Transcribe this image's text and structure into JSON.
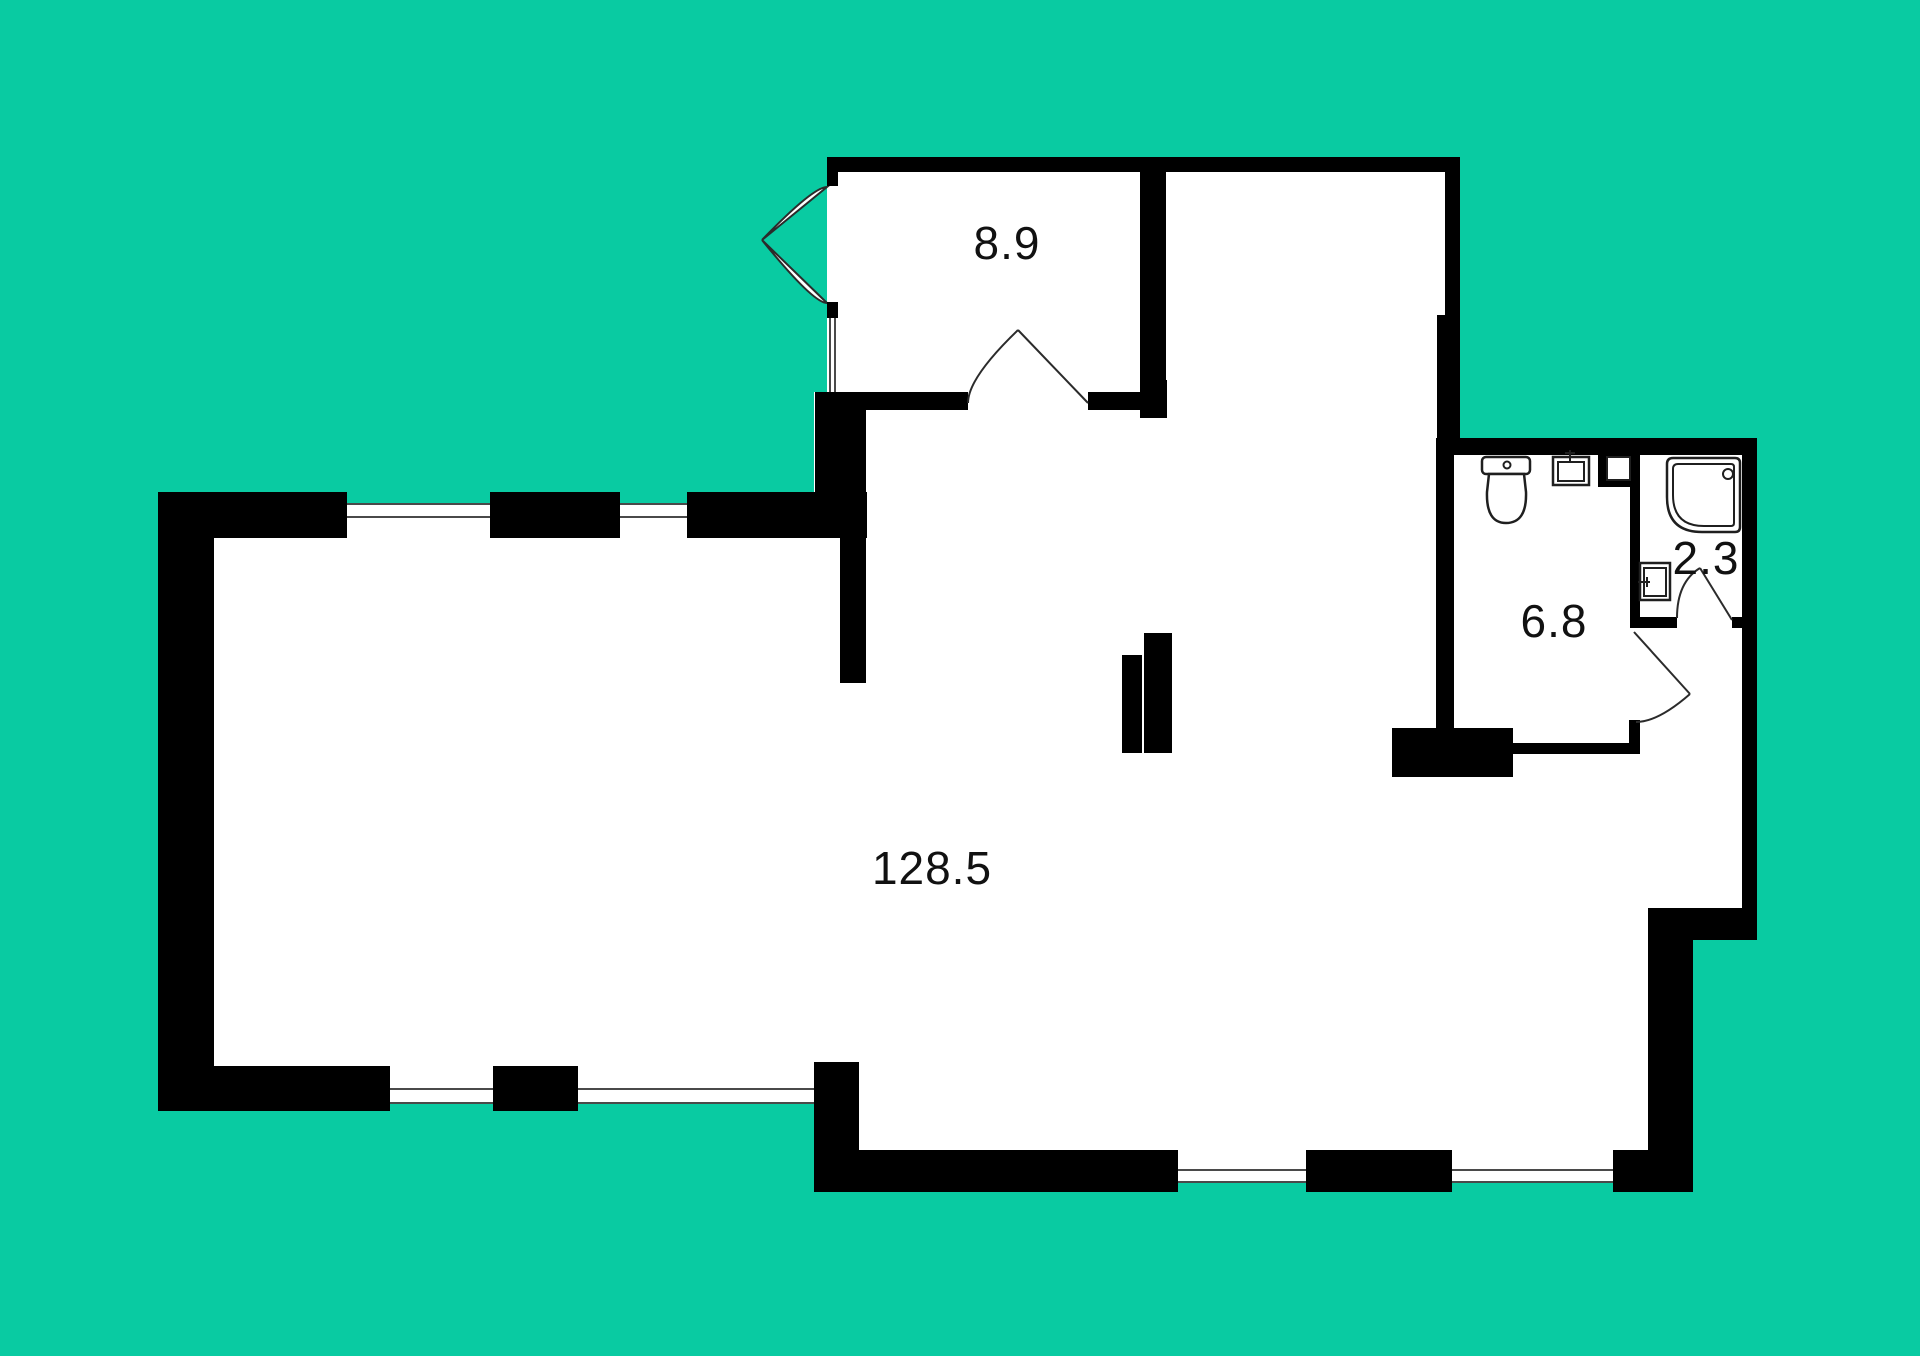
{
  "page_title": "Apartment floor plan",
  "colors": {
    "background": "#09CBA2",
    "walls": "#000000",
    "floor": "#FFFFFF",
    "lines": "#2B2B2B"
  },
  "rooms": {
    "living": {
      "name": "open living space",
      "area_label": "128.5"
    },
    "top_room": {
      "name": "room",
      "area_label": "8.9"
    },
    "bathroom": {
      "name": "bathroom",
      "area_label": "6.8"
    },
    "shower_room": {
      "name": "shower room",
      "area_label": "2.3"
    }
  },
  "fixtures": [
    "toilet-icon",
    "washbasin-icon",
    "shower-tray-icon",
    "small-washbasin-icon",
    "duct-shaft-icon"
  ]
}
